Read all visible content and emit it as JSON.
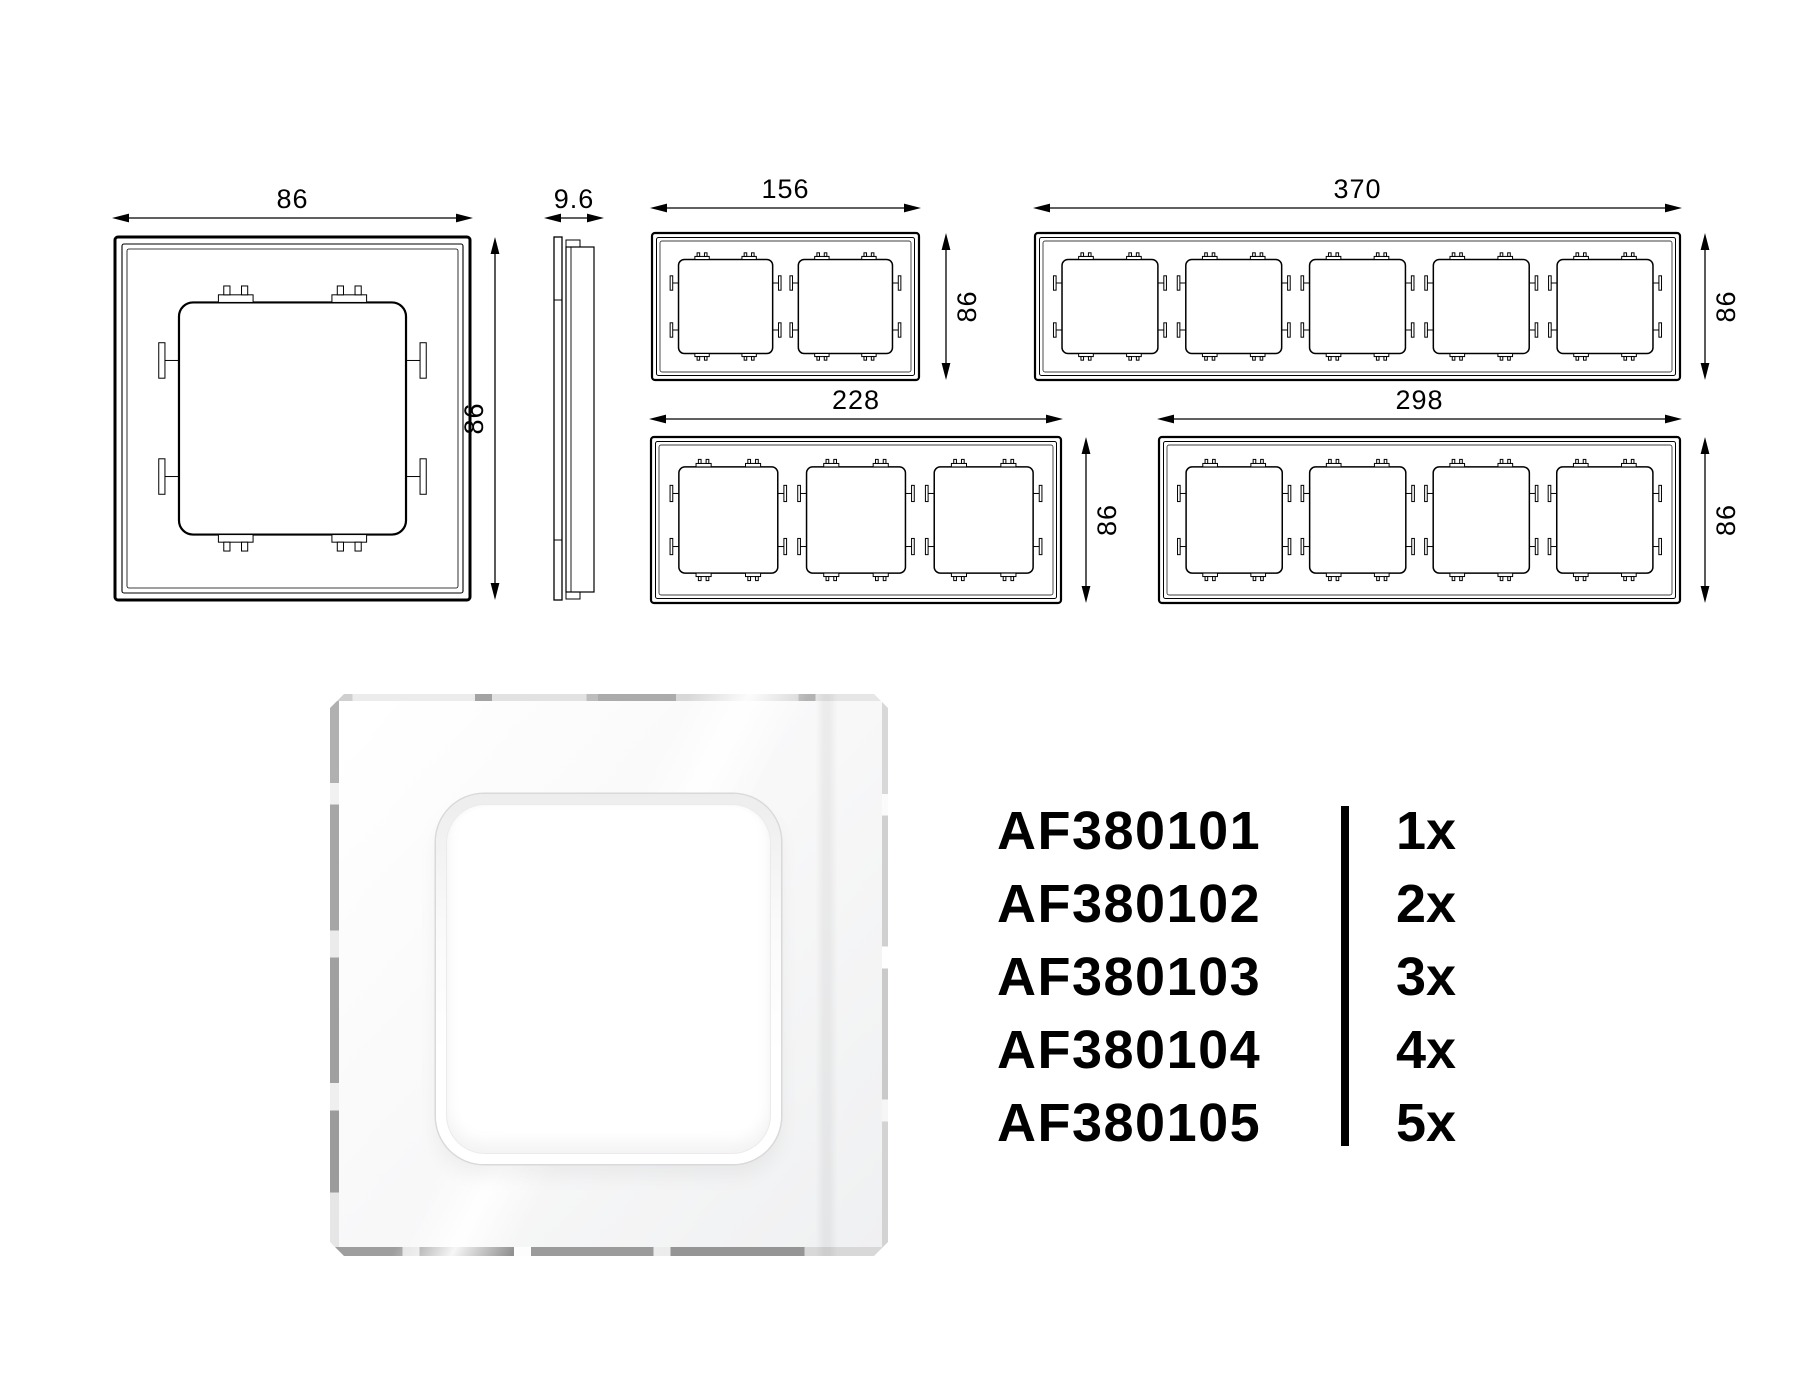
{
  "technical_drawings": {
    "front_view": {
      "width_label": "86",
      "height_label": "86",
      "gangs": 1
    },
    "side_view": {
      "thickness_label": "9.6"
    },
    "multi_gang_frames": [
      {
        "gangs": 2,
        "width_label": "156",
        "height_label": "86"
      },
      {
        "gangs": 5,
        "width_label": "370",
        "height_label": "86"
      },
      {
        "gangs": 3,
        "width_label": "228",
        "height_label": "86"
      },
      {
        "gangs": 4,
        "width_label": "298",
        "height_label": "86"
      }
    ]
  },
  "product_list": {
    "rows": [
      {
        "code": "AF380101",
        "qty": "1x"
      },
      {
        "code": "AF380102",
        "qty": "2x"
      },
      {
        "code": "AF380103",
        "qty": "3x"
      },
      {
        "code": "AF380104",
        "qty": "4x"
      },
      {
        "code": "AF380105",
        "qty": "5x"
      }
    ]
  },
  "colors": {
    "line": "#000000",
    "text": "#000000",
    "divider": "#000000",
    "page_background": "#ffffff",
    "bevel_gray": "#a6a6a6"
  }
}
